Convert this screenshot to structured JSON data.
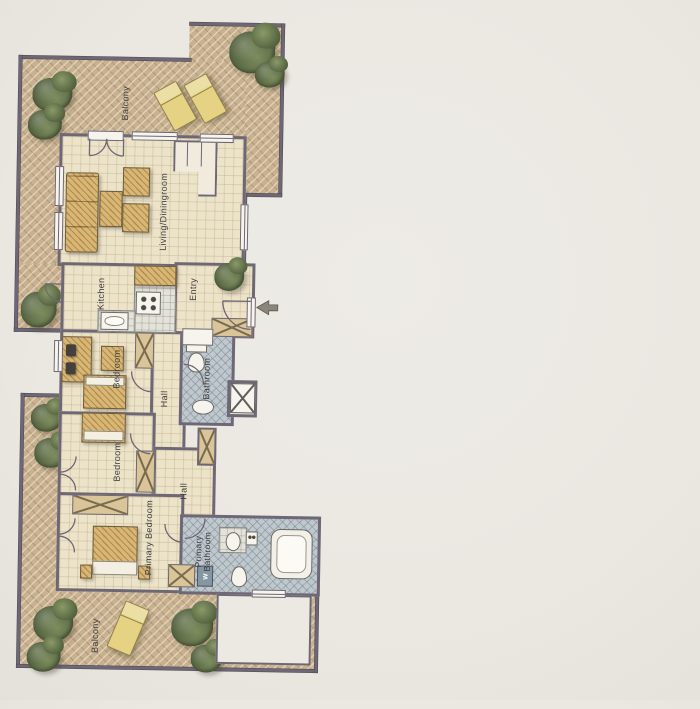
{
  "rooms": {
    "balcony_top": "Balcony",
    "living": "Living/Diningroom",
    "kitchen": "Kitchen",
    "entry": "Entry",
    "bedroom_1": "Bedroom",
    "hall_1": "Hall",
    "bathroom": "Bathroom",
    "bedroom_2": "Bedroom",
    "hall_2": "Hall",
    "primary_bedroom": "Primary Bedroom",
    "primary_bathroom": "Primary Bathroom",
    "balcony_bottom": "Balcony"
  },
  "fixtures": {
    "washer_label": "W"
  },
  "colors": {
    "page_bg": "#ebe8e2",
    "wall": "#6e6775",
    "floor": "#ece3c9",
    "balcony": "#c8b190",
    "bath_tile": "#bfc8cd",
    "wood": "#d8b775",
    "plant": "#5c6b44",
    "lounge": "#e5d383",
    "label": "#3f3e3e"
  }
}
